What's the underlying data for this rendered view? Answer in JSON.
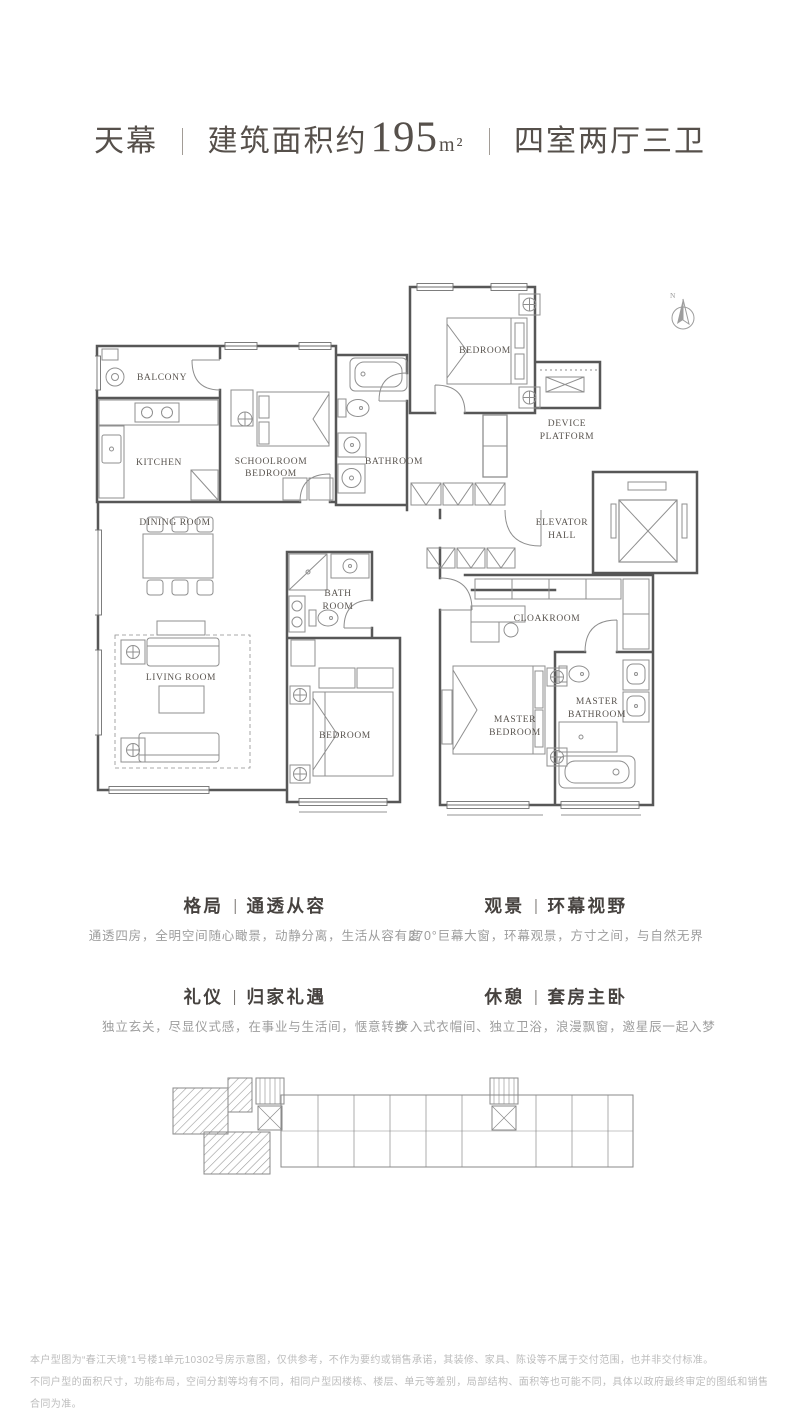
{
  "header": {
    "project_name": "天幕",
    "area_prefix": "建筑面积约",
    "area_value": "195",
    "area_unit": "m²",
    "layout_spec": "四室两厅三卫"
  },
  "floorplan": {
    "compass": "N",
    "rooms": {
      "balcony": "BALCONY",
      "kitchen": "KITCHEN",
      "schoolroom_line1": "SCHOOLROOM",
      "schoolroom_line2": "BEDROOM",
      "bathroom": "BATHROOM",
      "bedroom_north": "BEDROOM",
      "device_line1": "DEVICE",
      "device_line2": "PLATFORM",
      "elevator_line1": "ELEVATOR",
      "elevator_line2": "HALL",
      "dining": "DINING ROOM",
      "bath_line1": "BATH",
      "bath_line2": "ROOM",
      "cloakroom": "CLOAKROOM",
      "living": "LIVING ROOM",
      "bedroom_mid": "BEDROOM",
      "master_bed_line1": "MASTER",
      "master_bed_line2": "BEDROOM",
      "master_bath_line1": "MASTER",
      "master_bath_line2": "BATHROOM"
    }
  },
  "features": [
    {
      "category": "格局",
      "title": "通透从容",
      "description": "通透四房，全明空间随心瞰景，动静分离，生活从容有度"
    },
    {
      "category": "观景",
      "title": "环幕视野",
      "description": "270°巨幕大窗，环幕观景，方寸之间，与自然无界"
    },
    {
      "category": "礼仪",
      "title": "归家礼遇",
      "description": "独立玄关，尽显仪式感，在事业与生活间，惬意转换"
    },
    {
      "category": "休憩",
      "title": "套房主卧",
      "description": "步入式衣帽间、独立卫浴，浪漫飘窗，邀星辰一起入梦"
    }
  ],
  "disclaimer": {
    "line1": "本户型图为“春江天境”1号楼1单元10302号房示意图，仅供参考，不作为要约或销售承诺，其装修、家具、陈设等不属于交付范围，也并非交付标准。",
    "line2": "不同户型的面积尺寸，功能布局，空间分割等均有不同，相同户型因楼栋、楼层、单元等差别，局部结构、面积等也可能不同，具体以政府最终审定的图纸和销售合同为准。"
  }
}
